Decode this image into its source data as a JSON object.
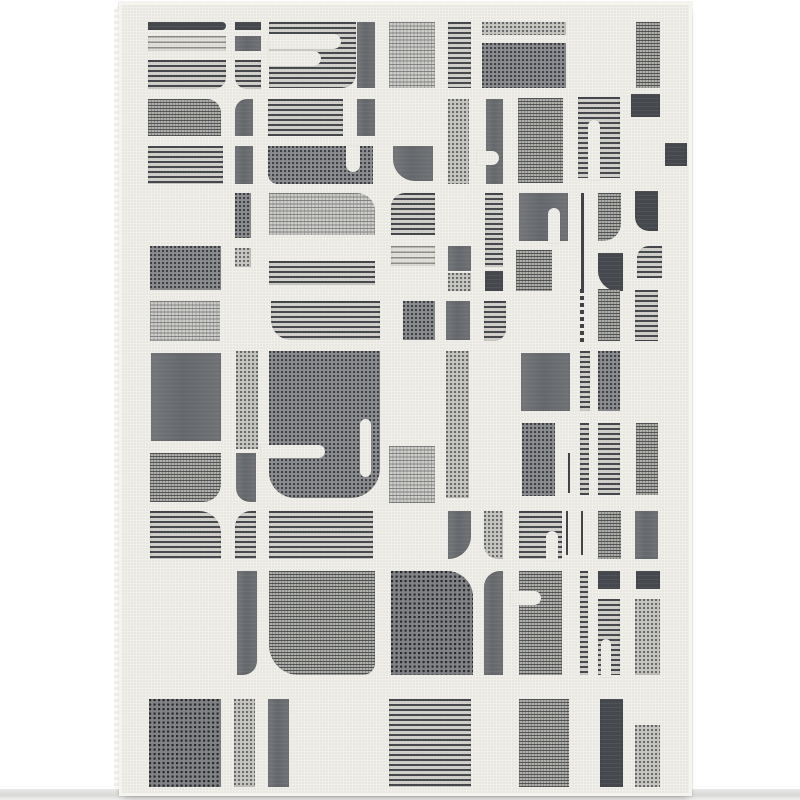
{
  "image": {
    "type": "product-photo",
    "subject": "Modern abstract geometric area rug, ivory field with gray blocks, stripes and dotted textures",
    "background_color": "#ffffff",
    "rug": {
      "left": 119,
      "top": 2,
      "width": 567,
      "height": 788,
      "field_color": "#f0efe9",
      "edge_color": "#f5f4ef",
      "palette": {
        "dark_gray": "#44474c",
        "slate_gray": "#64676b",
        "mid_gray": "#8b8d90",
        "light_gray": "#c9c8c2",
        "stripe_line": "#45484d",
        "stripe_ground": "#d3d1cb"
      },
      "blocks_format": [
        "x",
        "y",
        "width",
        "height",
        "texture",
        "corner_radius"
      ],
      "blocks": [
        [
          26,
          17,
          78,
          8,
          "solidDark",
          "0 4px 4px 0"
        ],
        [
          113,
          17,
          26,
          8,
          "solidDark",
          "0"
        ],
        [
          26,
          31,
          78,
          15,
          "stripesLight",
          "0"
        ],
        [
          113,
          31,
          26,
          15,
          "solid",
          "0"
        ],
        [
          26,
          55,
          78,
          29,
          "stripes",
          "0 0 12px 0"
        ],
        [
          113,
          55,
          26,
          29,
          "stripes",
          "0 0 0 12px"
        ],
        [
          147,
          17,
          87,
          66,
          "stripes",
          "0 0 14px 0"
        ],
        [
          235,
          17,
          18,
          66,
          "solid",
          "0"
        ],
        [
          267,
          17,
          46,
          66,
          "meshLight",
          "0"
        ],
        [
          326,
          17,
          23,
          66,
          "stripes",
          "0"
        ],
        [
          360,
          17,
          84,
          13,
          "dotsLight",
          "0"
        ],
        [
          360,
          38,
          84,
          45,
          "dots",
          "0"
        ],
        [
          514,
          17,
          24,
          66,
          "mesh",
          "0"
        ],
        [
          26,
          94,
          73,
          37,
          "mesh",
          "0 14px 0 0"
        ],
        [
          113,
          94,
          18,
          37,
          "solid",
          "12px 0 0 0"
        ],
        [
          146,
          94,
          75,
          37,
          "stripes",
          "0"
        ],
        [
          235,
          94,
          18,
          37,
          "solid",
          "0"
        ],
        [
          26,
          141,
          75,
          38,
          "stripes",
          "0"
        ],
        [
          113,
          141,
          18,
          38,
          "solid",
          "0"
        ],
        [
          146,
          141,
          105,
          38,
          "dots",
          "0 0 0 10px"
        ],
        [
          271,
          141,
          40,
          35,
          "solid",
          "0 0 0 22px"
        ],
        [
          326,
          94,
          21,
          85,
          "dotsLight",
          "0"
        ],
        [
          364,
          94,
          17,
          85,
          "solid",
          "0"
        ],
        [
          396,
          93,
          45,
          85,
          "mesh",
          "0"
        ],
        [
          456,
          92,
          42,
          81,
          "stripes",
          "0"
        ],
        [
          509,
          89,
          29,
          23,
          "solidDark",
          "0"
        ],
        [
          543,
          138,
          22,
          23,
          "solidDark",
          "0"
        ],
        [
          113,
          188,
          16,
          45,
          "dots",
          "0"
        ],
        [
          147,
          188,
          106,
          42,
          "meshLight",
          "0 18px 0 0"
        ],
        [
          269,
          188,
          44,
          42,
          "stripes",
          "14px 0 0 0"
        ],
        [
          363,
          188,
          18,
          74,
          "stripes",
          "0"
        ],
        [
          397,
          188,
          49,
          48,
          "solid",
          "0"
        ],
        [
          459,
          188,
          3,
          100,
          "thinline",
          "0"
        ],
        [
          476,
          188,
          23,
          48,
          "mesh",
          "0 0 18px 0"
        ],
        [
          513,
          186,
          23,
          40,
          "solidDark",
          "0 0 0 14px"
        ],
        [
          28,
          241,
          71,
          44,
          "dots",
          "0"
        ],
        [
          113,
          243,
          16,
          19,
          "dotsLight",
          "0"
        ],
        [
          147,
          256,
          106,
          24,
          "stripes",
          "0"
        ],
        [
          269,
          241,
          44,
          20,
          "stripesLight",
          "0"
        ],
        [
          326,
          241,
          23,
          25,
          "solid",
          "0"
        ],
        [
          326,
          268,
          23,
          18,
          "dotsLight",
          "0"
        ],
        [
          394,
          245,
          36,
          41,
          "mesh",
          "0"
        ],
        [
          363,
          266,
          18,
          20,
          "solidDark",
          "0"
        ],
        [
          476,
          248,
          25,
          38,
          "solidDark",
          "0 0 0 20px"
        ],
        [
          515,
          241,
          25,
          32,
          "stripes",
          "12px 0 0 0"
        ],
        [
          28,
          296,
          70,
          40,
          "meshLight",
          "0"
        ],
        [
          149,
          296,
          109,
          39,
          "stripes",
          "0 0 0 20px"
        ],
        [
          281,
          296,
          32,
          39,
          "dots",
          "0"
        ],
        [
          324,
          296,
          24,
          39,
          "solid",
          "0"
        ],
        [
          362,
          296,
          22,
          40,
          "stripes",
          "0 0 12px 0"
        ],
        [
          458,
          284,
          4,
          54,
          "dashline",
          "0"
        ],
        [
          476,
          284,
          22,
          52,
          "mesh",
          "0"
        ],
        [
          513,
          285,
          23,
          51,
          "stripes",
          "0"
        ],
        [
          29,
          348,
          70,
          88,
          "solid",
          "0"
        ],
        [
          114,
          346,
          22,
          98,
          "dotsLight",
          "0"
        ],
        [
          147,
          346,
          111,
          147,
          "dots",
          "0 0 30px 26px"
        ],
        [
          324,
          346,
          23,
          147,
          "dotsLight",
          "0"
        ],
        [
          399,
          348,
          49,
          58,
          "solid",
          "0"
        ],
        [
          458,
          346,
          10,
          60,
          "stripes",
          "0"
        ],
        [
          476,
          346,
          22,
          60,
          "dots",
          "0"
        ],
        [
          400,
          418,
          33,
          73,
          "dots",
          "0"
        ],
        [
          446,
          448,
          2,
          40,
          "thinline",
          "0"
        ],
        [
          458,
          418,
          9,
          72,
          "stripes",
          "0"
        ],
        [
          476,
          418,
          22,
          72,
          "stripes",
          "0"
        ],
        [
          514,
          418,
          22,
          72,
          "mesh",
          "0"
        ],
        [
          267,
          441,
          46,
          57,
          "meshLight",
          "0"
        ],
        [
          28,
          448,
          71,
          49,
          "mesh",
          "0 0 18px 0"
        ],
        [
          114,
          448,
          20,
          49,
          "solid",
          "0 0 0 14px"
        ],
        [
          28,
          506,
          71,
          48,
          "stripes",
          "0 22px 0 0"
        ],
        [
          113,
          506,
          21,
          48,
          "stripes",
          "16px 0 0 0"
        ],
        [
          147,
          506,
          104,
          48,
          "stripes",
          "0"
        ],
        [
          326,
          506,
          23,
          48,
          "solid",
          "0 0 24px 0"
        ],
        [
          362,
          506,
          19,
          48,
          "dotsLight",
          "0 0 0 14px"
        ],
        [
          397,
          506,
          43,
          48,
          "stripes",
          "0"
        ],
        [
          444,
          506,
          2,
          44,
          "thinline",
          "0"
        ],
        [
          459,
          506,
          2,
          44,
          "thinline",
          "0"
        ],
        [
          476,
          506,
          23,
          48,
          "mesh",
          "0"
        ],
        [
          513,
          506,
          23,
          48,
          "solid",
          "0"
        ],
        [
          115,
          566,
          20,
          104,
          "solid",
          "0 0 14px 0"
        ],
        [
          147,
          566,
          106,
          104,
          "mesh",
          "0 0 12px 30px"
        ],
        [
          269,
          566,
          82,
          104,
          "dotsDark",
          "0 26px 0 0"
        ],
        [
          362,
          566,
          19,
          104,
          "solid",
          "16px 0 0 0"
        ],
        [
          397,
          566,
          43,
          104,
          "mesh",
          "0"
        ],
        [
          458,
          566,
          8,
          104,
          "stripes",
          "0"
        ],
        [
          476,
          566,
          22,
          18,
          "solidDark",
          "0"
        ],
        [
          476,
          594,
          22,
          76,
          "stripes",
          "0"
        ],
        [
          514,
          566,
          24,
          18,
          "solidDark",
          "0"
        ],
        [
          513,
          594,
          25,
          76,
          "dotsLight",
          "0"
        ],
        [
          27,
          694,
          72,
          88,
          "dotsDark",
          "0"
        ],
        [
          112,
          694,
          21,
          88,
          "dotsLight",
          "0"
        ],
        [
          146,
          694,
          21,
          88,
          "solid",
          "0"
        ],
        [
          267,
          694,
          82,
          88,
          "stripes",
          "0"
        ],
        [
          397,
          694,
          50,
          88,
          "mesh",
          "0"
        ],
        [
          478,
          694,
          23,
          88,
          "solidDark",
          "0"
        ],
        [
          513,
          720,
          25,
          62,
          "dotsLight",
          "0"
        ]
      ],
      "slots_format": [
        "x",
        "y",
        "width",
        "height",
        "corner_radius"
      ],
      "slots": [
        [
          147,
          29,
          72,
          15,
          "0 8px 8px 0"
        ],
        [
          147,
          46,
          52,
          15,
          "0 8px 8px 0"
        ],
        [
          224,
          141,
          14,
          26,
          "0 0 7px 7px"
        ],
        [
          355,
          146,
          22,
          14,
          "0 7px 7px 0"
        ],
        [
          466,
          115,
          12,
          60,
          "6px 6px 0 0"
        ],
        [
          426,
          203,
          12,
          35,
          "6px 6px 0 0"
        ],
        [
          139,
          440,
          64,
          13,
          "0 7px 7px 0"
        ],
        [
          238,
          414,
          11,
          58,
          "6px"
        ],
        [
          424,
          526,
          12,
          30,
          "6px 6px 0 0"
        ],
        [
          389,
          586,
          30,
          14,
          "0 7px 7px 0"
        ],
        [
          479,
          634,
          10,
          38,
          "5px 5px 0 0"
        ]
      ]
    }
  }
}
